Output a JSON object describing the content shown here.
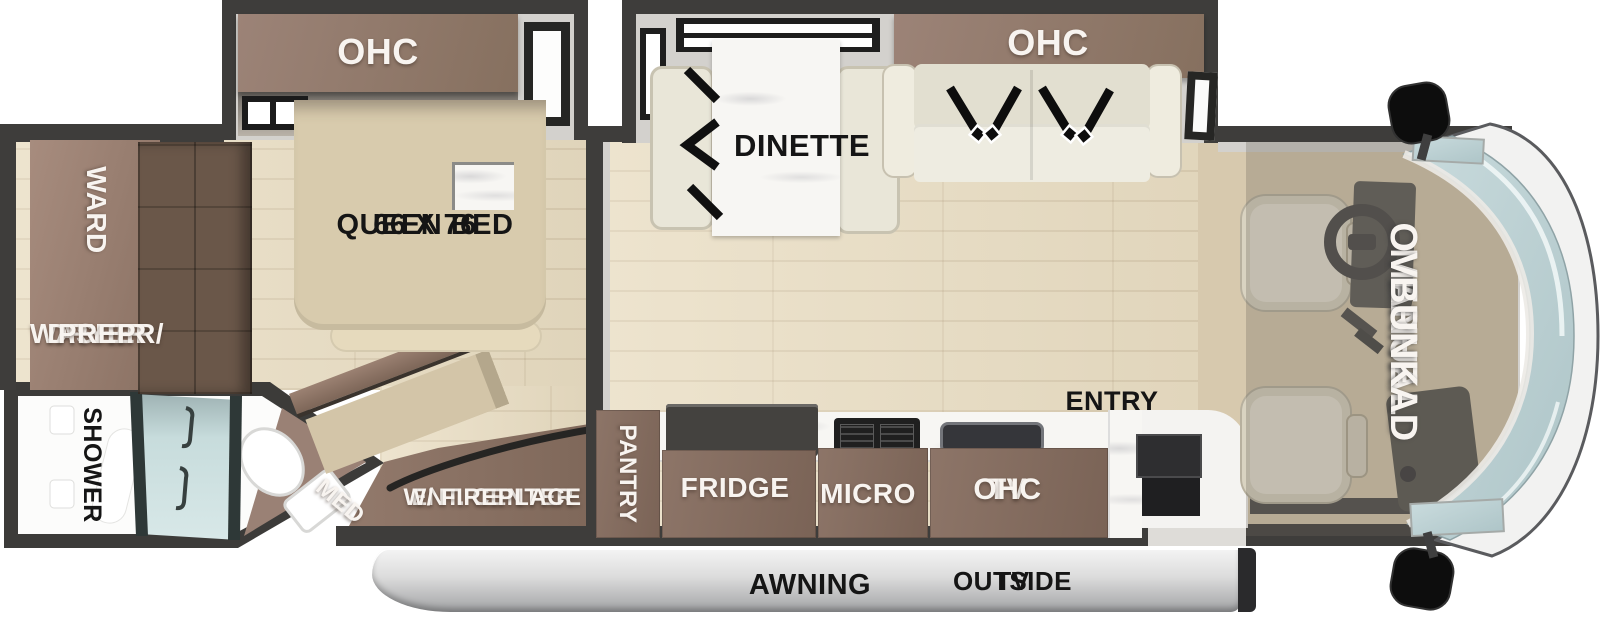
{
  "labels": {
    "bedroom_ohc": "OHC",
    "ward": "WARD",
    "washer_dryer_prep": [
      "WASHER/",
      "DRYER",
      "PREP"
    ],
    "queen_bed": [
      "66 X 76",
      "QUEEN BED"
    ],
    "shower": "SHOWER",
    "med": "MED",
    "ent_center": [
      "ENT. CENTER",
      "W/ FIREPLACE"
    ],
    "dinette": "DINETTE",
    "living_ohc": "OHC",
    "pantry": "PANTRY",
    "fridge": "FRIDGE",
    "micro": "MICRO",
    "tv_ohc": [
      "TV",
      "OHC"
    ],
    "entry": "ENTRY",
    "overhead_bunk": [
      "MANUAL",
      "OVERHEAD",
      "BUNK"
    ],
    "awning": "AWNING",
    "outside_tv": [
      "OUTSIDE",
      "TV"
    ]
  },
  "colors": {
    "wall": "#3e3d3b",
    "wall_inner": "#d3d1cd",
    "floor_wood": "#e9ddc2",
    "cab_carpet": "#d7c9ae",
    "cabinet_mauve": "#9c8377",
    "cabinet_mauve_dark": "#86705f",
    "cabinet_dark": "#6a5749",
    "cabinet_kitchen": "#8d7568",
    "cream": "#e9e6d8",
    "tan_bed": "#d8cbad",
    "marble": "#f7f6f3",
    "shower_glass": "#c7dcdc",
    "windshield": "#bdd2d4",
    "awning_hi": "#f5f5f5",
    "awning_lo": "#a2a3a5",
    "label_light": "#f8f4f0",
    "label_dark": "#151515"
  }
}
